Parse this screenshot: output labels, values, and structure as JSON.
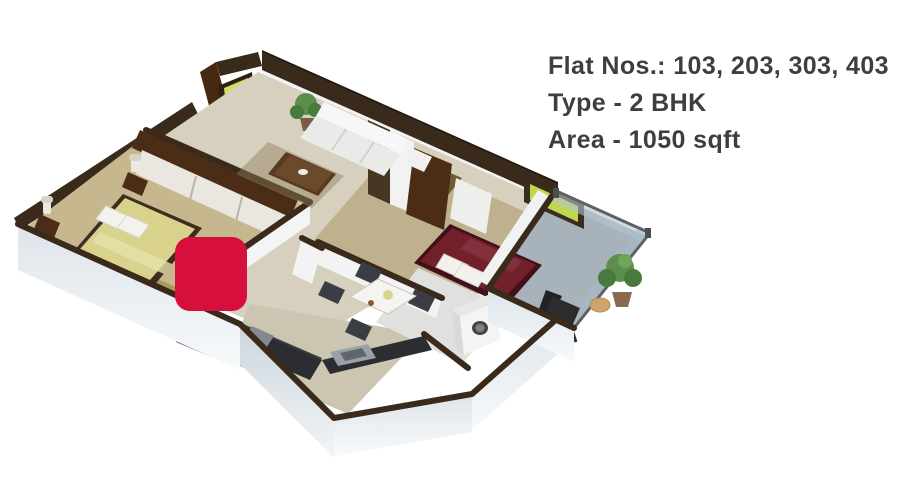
{
  "info_panel": {
    "line1": "Flat Nos.: 103, 203, 303, 403",
    "line2": "Type - 2 BHK",
    "line3": "Area - 1050 sqft"
  },
  "colors": {
    "text_gray": "#3e3e3e",
    "marker_red": "#d60f3d",
    "wall_top": "#3a2a1c",
    "wood_brown": "#4b2d17",
    "floor_beige": "#d7d0bf",
    "bed_yellow": "#d8d28d",
    "bed_maroon": "#72202a",
    "tv_green": "#ccdf5e",
    "glass_green": "#bfd84d",
    "plant_green": "#5c8f4b",
    "balcony_gray": "#a7b2ba",
    "counter_dark": "#2b2d31",
    "chair_dark": "#3a3d43",
    "background": "#ffffff"
  }
}
